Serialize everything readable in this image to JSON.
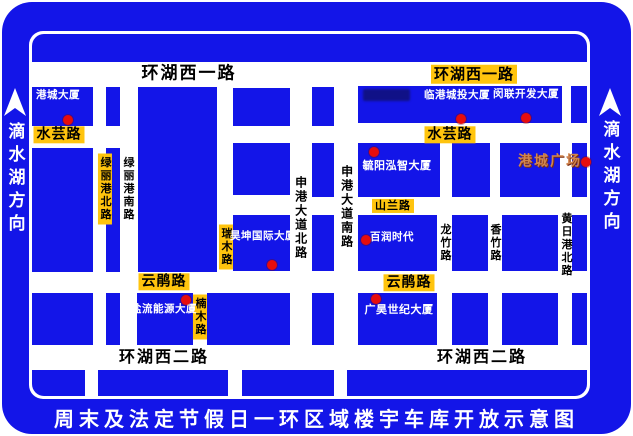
{
  "colors": {
    "blue": "#1315e8",
    "yellow": "#ffc40e",
    "red": "#e60d0d",
    "plaza_text": "#d1854e",
    "road_white": "#ffffff",
    "text_black": "#000000",
    "text_white": "#ffffff"
  },
  "frame": {
    "bottom_title": "周末及法定节假日一环区域楼宇车库开放示意图",
    "left_direction": {
      "text": "滴水湖方向",
      "arrow": "up-arrow"
    },
    "right_direction": {
      "text": "滴水湖方向",
      "arrow": "up-arrow"
    }
  },
  "map": {
    "roads": {
      "horizontal": [
        "环湖西一路",
        "水芸路",
        "山兰路",
        "云鹃路",
        "环湖西二路"
      ],
      "vertical": [
        "绿丽港北路",
        "绿丽港南路",
        "瑞木路",
        "楠木路",
        "申港大道北路",
        "申港大道南路",
        "龙竹路",
        "香竹路",
        "黄日港北路"
      ]
    },
    "buildings": [
      "港城大厦",
      "临港城投大厦",
      "闵联开发大厦",
      "毓阳泓智大厦",
      "港城广场",
      "昊坤国际大厦",
      "百润时代",
      "广昊世纪大厦",
      "盐流能源大厦"
    ],
    "blocks": [
      {
        "x": 32,
        "y": 34,
        "w": 555,
        "h": 28,
        "r": "12px 12px 0 0"
      },
      {
        "x": 32,
        "y": 87,
        "w": 61,
        "h": 39
      },
      {
        "x": 106,
        "y": 87,
        "w": 14,
        "h": 39
      },
      {
        "x": 138,
        "y": 87,
        "w": 79,
        "h": 185
      },
      {
        "x": 233,
        "y": 88,
        "w": 57,
        "h": 38
      },
      {
        "x": 312,
        "y": 87,
        "w": 22,
        "h": 39
      },
      {
        "x": 358,
        "y": 86,
        "w": 204,
        "h": 37
      },
      {
        "x": 571,
        "y": 86,
        "w": 16,
        "h": 37
      },
      {
        "x": 32,
        "y": 148,
        "w": 61,
        "h": 124
      },
      {
        "x": 106,
        "y": 148,
        "w": 14,
        "h": 124
      },
      {
        "x": 233,
        "y": 143,
        "w": 57,
        "h": 52
      },
      {
        "x": 312,
        "y": 143,
        "w": 22,
        "h": 54
      },
      {
        "x": 358,
        "y": 143,
        "w": 82,
        "h": 54
      },
      {
        "x": 452,
        "y": 143,
        "w": 38,
        "h": 54
      },
      {
        "x": 500,
        "y": 143,
        "w": 60,
        "h": 54
      },
      {
        "x": 572,
        "y": 143,
        "w": 15,
        "h": 54
      },
      {
        "x": 233,
        "y": 215,
        "w": 57,
        "h": 56
      },
      {
        "x": 312,
        "y": 215,
        "w": 22,
        "h": 56
      },
      {
        "x": 358,
        "y": 215,
        "w": 79,
        "h": 56
      },
      {
        "x": 452,
        "y": 215,
        "w": 36,
        "h": 56
      },
      {
        "x": 502,
        "y": 215,
        "w": 56,
        "h": 56
      },
      {
        "x": 572,
        "y": 215,
        "w": 15,
        "h": 56
      },
      {
        "x": 32,
        "y": 293,
        "w": 61,
        "h": 52
      },
      {
        "x": 106,
        "y": 293,
        "w": 14,
        "h": 52
      },
      {
        "x": 137,
        "y": 293,
        "w": 56,
        "h": 52
      },
      {
        "x": 207,
        "y": 293,
        "w": 83,
        "h": 52
      },
      {
        "x": 312,
        "y": 293,
        "w": 22,
        "h": 52
      },
      {
        "x": 358,
        "y": 293,
        "w": 79,
        "h": 52
      },
      {
        "x": 452,
        "y": 293,
        "w": 36,
        "h": 52
      },
      {
        "x": 502,
        "y": 293,
        "w": 56,
        "h": 52
      },
      {
        "x": 572,
        "y": 293,
        "w": 15,
        "h": 52
      },
      {
        "x": 32,
        "y": 370,
        "w": 53,
        "h": 26,
        "r": "0 0 0 12px"
      },
      {
        "x": 98,
        "y": 370,
        "w": 130,
        "h": 26
      },
      {
        "x": 242,
        "y": 370,
        "w": 92,
        "h": 26
      },
      {
        "x": 347,
        "y": 370,
        "w": 240,
        "h": 26,
        "r": "0 0 12px 0"
      }
    ],
    "labels": [
      {
        "t": "环湖西一路",
        "x": 189,
        "y": 74,
        "s": 17,
        "type": "ph"
      },
      {
        "t": "环湖西二路",
        "x": 164,
        "y": 357,
        "s": 16,
        "type": "ph"
      },
      {
        "t": "环湖西二路",
        "x": 482,
        "y": 357,
        "s": 16,
        "type": "ph"
      },
      {
        "t": "环湖西一路",
        "x": 474,
        "y": 74,
        "s": 15,
        "type": "yh"
      },
      {
        "t": "水芸路",
        "x": 59,
        "y": 135,
        "s": 14,
        "type": "yh"
      },
      {
        "t": "水芸路",
        "x": 450,
        "y": 135,
        "s": 14,
        "type": "yh"
      },
      {
        "t": "山兰路",
        "x": 393,
        "y": 206,
        "s": 11,
        "type": "yh"
      },
      {
        "t": "云鹃路",
        "x": 164,
        "y": 282,
        "s": 14,
        "type": "yh"
      },
      {
        "t": "云鹃路",
        "x": 409,
        "y": 283,
        "s": 14,
        "type": "yh"
      },
      {
        "t": "绿丽港北路",
        "x": 105,
        "y": 189,
        "s": 11,
        "type": "yv"
      },
      {
        "t": "瑞木路",
        "x": 226,
        "y": 247,
        "s": 11,
        "type": "yv"
      },
      {
        "t": "楠木路",
        "x": 200,
        "y": 317,
        "s": 11,
        "type": "yv"
      },
      {
        "t": "绿丽港南路",
        "x": 128,
        "y": 189,
        "s": 11,
        "type": "pv"
      },
      {
        "t": "申港大道北路",
        "x": 300,
        "y": 218,
        "s": 12,
        "type": "pv"
      },
      {
        "t": "申港大道南路",
        "x": 346,
        "y": 207,
        "s": 12,
        "type": "pv"
      },
      {
        "t": "龙竹路",
        "x": 445,
        "y": 243,
        "s": 11,
        "type": "pv"
      },
      {
        "t": "香竹路",
        "x": 495,
        "y": 243,
        "s": 11,
        "type": "pv"
      },
      {
        "t": "黄日港北路",
        "x": 566,
        "y": 245,
        "s": 11,
        "type": "pv"
      },
      {
        "t": "港城大厦",
        "x": 58,
        "y": 96,
        "s": 10.5,
        "type": "bld"
      },
      {
        "t": "临港城投大厦",
        "x": 457,
        "y": 96,
        "s": 10.5,
        "type": "bld"
      },
      {
        "t": "闵联开发大厦",
        "x": 526,
        "y": 95,
        "s": 10.5,
        "type": "bld"
      },
      {
        "t": "毓阳泓智大厦",
        "x": 397,
        "y": 166,
        "s": 11,
        "type": "bld"
      },
      {
        "t": "昊坤国际大厦",
        "x": 263,
        "y": 237,
        "s": 10.5,
        "type": "bld"
      },
      {
        "t": "百润时代",
        "x": 392,
        "y": 238,
        "s": 10.5,
        "type": "bld"
      },
      {
        "t": "广昊世纪大厦",
        "x": 399,
        "y": 310,
        "s": 11,
        "type": "bld"
      },
      {
        "t": "盐流能源大厦",
        "x": 164,
        "y": 310,
        "s": 10.5,
        "type": "bld"
      },
      {
        "t": "港城广场",
        "x": 550,
        "y": 162,
        "s": 14,
        "type": "plz"
      }
    ],
    "dots": [
      {
        "x": 68,
        "y": 120
      },
      {
        "x": 461,
        "y": 119
      },
      {
        "x": 526,
        "y": 118
      },
      {
        "x": 374,
        "y": 152
      },
      {
        "x": 586,
        "y": 162
      },
      {
        "x": 272,
        "y": 265
      },
      {
        "x": 366,
        "y": 240
      },
      {
        "x": 186,
        "y": 300
      },
      {
        "x": 376,
        "y": 299
      }
    ],
    "illegible_marks": [
      {
        "x": 363,
        "y": 89,
        "w": 47,
        "h": 12
      }
    ]
  }
}
